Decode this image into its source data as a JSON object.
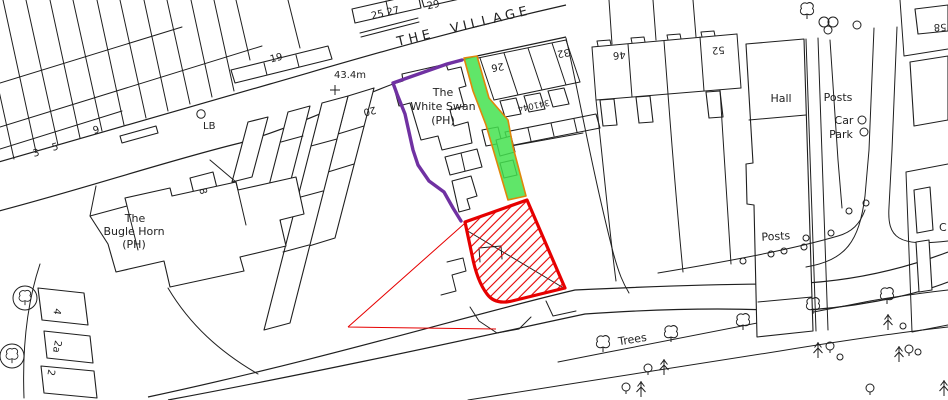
{
  "map": {
    "street_name": "THE VILLAGE",
    "spot_height": "43.4m",
    "parcel_number": "341044",
    "white_swan": {
      "l1": "The",
      "l2": "White Swan",
      "l3": "(PH)"
    },
    "bugle_horn": {
      "l1": "The",
      "l2": "Bugle Horn",
      "l3": "(PH)"
    },
    "labels": {
      "hall": "Hall",
      "posts_upper": "Posts",
      "posts_lower": "Posts",
      "car": "Car",
      "park": "Park",
      "trees": "Trees",
      "letter_box": "LB",
      "partial_c": "C"
    },
    "house_numbers": {
      "h2": "2",
      "h2a": "2a",
      "h3": "3",
      "h4": "4",
      "h5": "5",
      "h8": "8",
      "h9": "9",
      "h19": "19",
      "h20": "20",
      "h25_27": "25 27",
      "h26": "26",
      "h29": "29",
      "h32": "32",
      "h46": "46",
      "h52": "52",
      "h58": "58"
    },
    "colors": {
      "site_boundary": "#e60000",
      "hatch": "#e60000",
      "green_fill": "#44e24f",
      "green_border": "#e0860a",
      "purple_boundary": "#7031a2",
      "linework": "#1f1f1f"
    }
  }
}
